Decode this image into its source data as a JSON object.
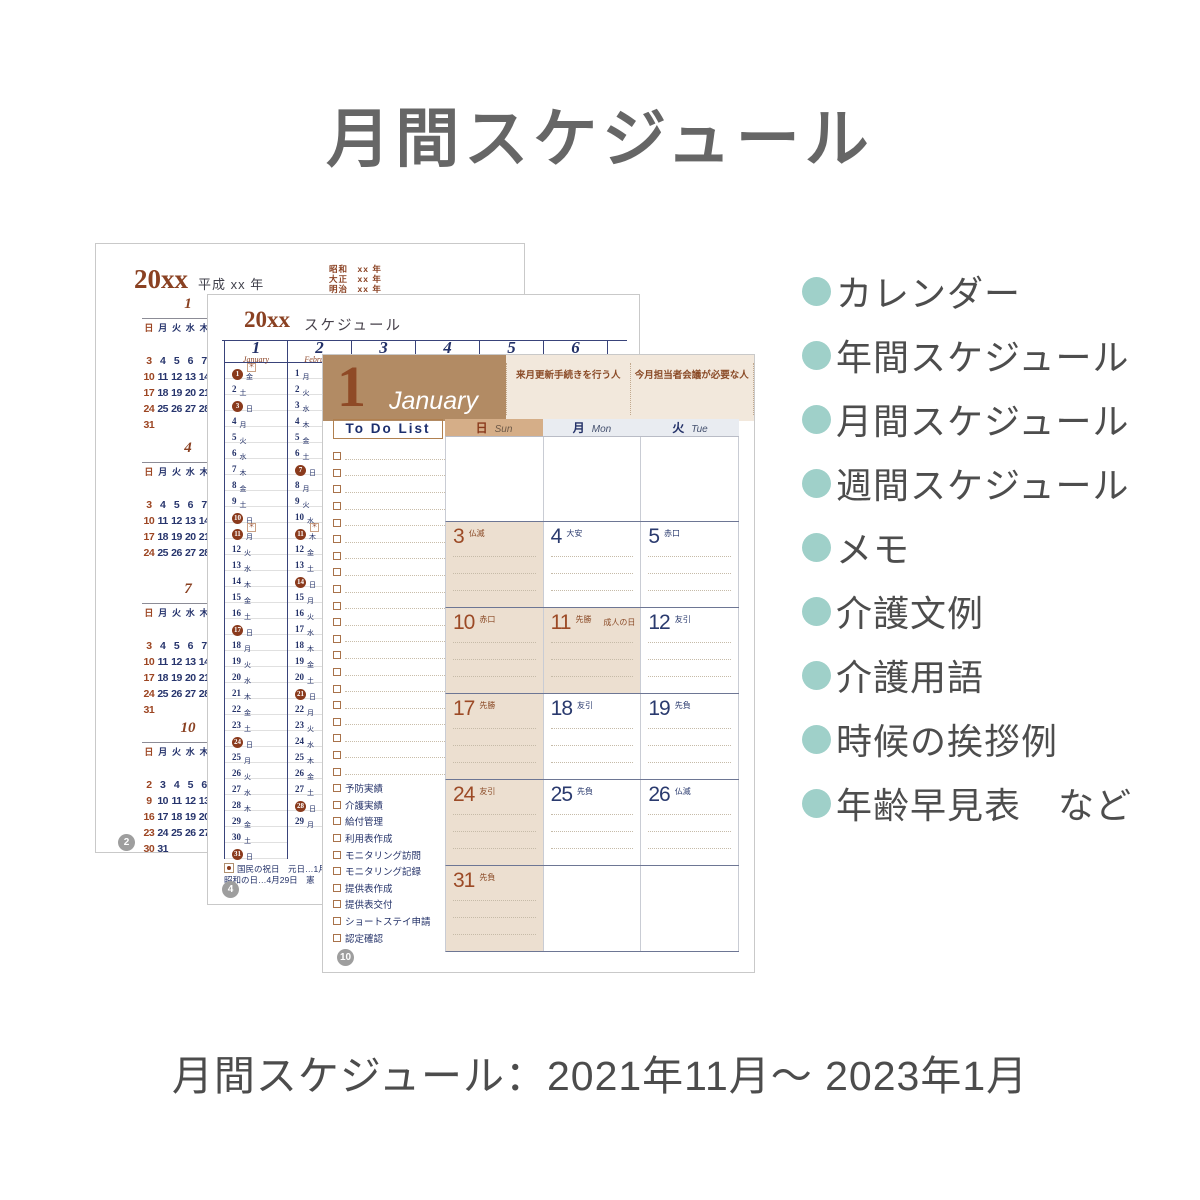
{
  "title": "月間スケジュール",
  "caption": "月間スケジュール：2021年11月～ 2023年1月",
  "features": {
    "bullet_color": "#9fd0c9",
    "items": [
      "カレンダー",
      "年間スケジュール",
      "月間スケジュール",
      "週間スケジュール",
      "メモ",
      "介護文例",
      "介護用語",
      "時候の挨拶例",
      "年齢早見表　など"
    ]
  },
  "colors": {
    "accent_teal": "#9fd0c9",
    "brown": "#8a4122",
    "navy": "#233168",
    "band_brown": "#b28b64",
    "band_beige": "#f2e8dc",
    "sunday_header": "#d5ae88",
    "weekday_header": "#e9ecf1",
    "sunday_cell": "#ecdfd0",
    "badge_gray": "#9e9e9e"
  },
  "page_calendar": {
    "page_number": "2",
    "year_label": "20xx",
    "era_label": "平成 xx 年",
    "era_small": [
      "昭和　xx 年",
      "大正　xx 年",
      "明治　xx 年"
    ],
    "weekdays": [
      "日",
      "月",
      "火",
      "水",
      "木",
      "金",
      "土"
    ],
    "months": [
      {
        "num": "1",
        "weeks": [
          [
            "",
            "",
            "",
            "",
            "",
            "1",
            "2"
          ],
          [
            "3",
            "4",
            "5",
            "6",
            "7",
            "8",
            "9"
          ],
          [
            "10",
            "11",
            "12",
            "13",
            "14",
            "15",
            "16"
          ],
          [
            "17",
            "18",
            "19",
            "20",
            "21",
            "22",
            "23"
          ],
          [
            "24",
            "25",
            "26",
            "27",
            "28",
            "29",
            "30"
          ],
          [
            "31",
            "",
            "",
            "",
            "",
            "",
            ""
          ]
        ]
      },
      {
        "num": "4",
        "weeks": [
          [
            "",
            "",
            "",
            "",
            "",
            "1",
            "2"
          ],
          [
            "3",
            "4",
            "5",
            "6",
            "7",
            "8",
            "9"
          ],
          [
            "10",
            "11",
            "12",
            "13",
            "14",
            "15",
            "16"
          ],
          [
            "17",
            "18",
            "19",
            "20",
            "21",
            "22",
            "23"
          ],
          [
            "24",
            "25",
            "26",
            "27",
            "28",
            "29",
            "30"
          ]
        ]
      },
      {
        "num": "7",
        "weeks": [
          [
            "",
            "",
            "",
            "",
            "",
            "1",
            "2"
          ],
          [
            "3",
            "4",
            "5",
            "6",
            "7",
            "8",
            "9"
          ],
          [
            "10",
            "11",
            "12",
            "13",
            "14",
            "15",
            "16"
          ],
          [
            "17",
            "18",
            "19",
            "20",
            "21",
            "22",
            "23"
          ],
          [
            "24",
            "25",
            "26",
            "27",
            "28",
            "29",
            "30"
          ],
          [
            "31",
            "",
            "",
            "",
            "",
            "",
            ""
          ]
        ]
      },
      {
        "num": "10",
        "weeks": [
          [
            "",
            "",
            "",
            "",
            "",
            "",
            "1"
          ],
          [
            "2",
            "3",
            "4",
            "5",
            "6",
            "7",
            "8"
          ],
          [
            "9",
            "10",
            "11",
            "12",
            "13",
            "14",
            "15"
          ],
          [
            "16",
            "17",
            "18",
            "19",
            "20",
            "21",
            "22"
          ],
          [
            "23",
            "24",
            "25",
            "26",
            "27",
            "28",
            "29"
          ],
          [
            "30",
            "31",
            "",
            "",
            "",
            "",
            ""
          ]
        ]
      }
    ]
  },
  "page_yearly": {
    "page_number": "4",
    "year_label": "20xx",
    "title": "スケジュール",
    "footnote1": "国民の祝日　元日…1月",
    "footnote2": "昭和の日…4月29日　憲",
    "columns": [
      {
        "num": "1",
        "name": "January",
        "days": [
          {
            "d": "1",
            "w": "金",
            "c": true,
            "m": true
          },
          {
            "d": "2",
            "w": "土"
          },
          {
            "d": "3",
            "w": "日",
            "c": true
          },
          {
            "d": "4",
            "w": "月"
          },
          {
            "d": "5",
            "w": "火"
          },
          {
            "d": "6",
            "w": "水"
          },
          {
            "d": "7",
            "w": "木"
          },
          {
            "d": "8",
            "w": "金"
          },
          {
            "d": "9",
            "w": "土"
          },
          {
            "d": "10",
            "w": "日",
            "c": true
          },
          {
            "d": "11",
            "w": "月",
            "c": true,
            "m": true
          },
          {
            "d": "12",
            "w": "火"
          },
          {
            "d": "13",
            "w": "水"
          },
          {
            "d": "14",
            "w": "木"
          },
          {
            "d": "15",
            "w": "金"
          },
          {
            "d": "16",
            "w": "土"
          },
          {
            "d": "17",
            "w": "日",
            "c": true
          },
          {
            "d": "18",
            "w": "月"
          },
          {
            "d": "19",
            "w": "火"
          },
          {
            "d": "20",
            "w": "水"
          },
          {
            "d": "21",
            "w": "木"
          },
          {
            "d": "22",
            "w": "金"
          },
          {
            "d": "23",
            "w": "土"
          },
          {
            "d": "24",
            "w": "日",
            "c": true
          },
          {
            "d": "25",
            "w": "月"
          },
          {
            "d": "26",
            "w": "火"
          },
          {
            "d": "27",
            "w": "水"
          },
          {
            "d": "28",
            "w": "木"
          },
          {
            "d": "29",
            "w": "金"
          },
          {
            "d": "30",
            "w": "土"
          },
          {
            "d": "31",
            "w": "日",
            "c": true
          }
        ]
      },
      {
        "num": "2",
        "name": "February",
        "days": [
          {
            "d": "1",
            "w": "月"
          },
          {
            "d": "2",
            "w": "火"
          },
          {
            "d": "3",
            "w": "水"
          },
          {
            "d": "4",
            "w": "木"
          },
          {
            "d": "5",
            "w": "金"
          },
          {
            "d": "6",
            "w": "土"
          },
          {
            "d": "7",
            "w": "日",
            "c": true
          },
          {
            "d": "8",
            "w": "月"
          },
          {
            "d": "9",
            "w": "火"
          },
          {
            "d": "10",
            "w": "水"
          },
          {
            "d": "11",
            "w": "木",
            "c": true,
            "m": true
          },
          {
            "d": "12",
            "w": "金"
          },
          {
            "d": "13",
            "w": "土"
          },
          {
            "d": "14",
            "w": "日",
            "c": true
          },
          {
            "d": "15",
            "w": "月"
          },
          {
            "d": "16",
            "w": "火"
          },
          {
            "d": "17",
            "w": "水"
          },
          {
            "d": "18",
            "w": "木"
          },
          {
            "d": "19",
            "w": "金"
          },
          {
            "d": "20",
            "w": "土"
          },
          {
            "d": "21",
            "w": "日",
            "c": true
          },
          {
            "d": "22",
            "w": "月"
          },
          {
            "d": "23",
            "w": "火"
          },
          {
            "d": "24",
            "w": "水"
          },
          {
            "d": "25",
            "w": "木"
          },
          {
            "d": "26",
            "w": "金"
          },
          {
            "d": "27",
            "w": "土"
          },
          {
            "d": "28",
            "w": "日",
            "c": true
          },
          {
            "d": "29",
            "w": "月"
          }
        ]
      },
      {
        "num": "3",
        "name": "March",
        "days": []
      },
      {
        "num": "4",
        "name": "April",
        "days": []
      },
      {
        "num": "5",
        "name": "May",
        "days": []
      },
      {
        "num": "6",
        "name": "June",
        "days": []
      }
    ]
  },
  "page_monthly": {
    "page_number": "10",
    "month_num": "1",
    "month_name": "January",
    "note_labels": [
      "来月更新手続きを行う人",
      "今月担当者会議が必要な人"
    ],
    "todo_title": "To Do List",
    "todo_empty_rows": 20,
    "todo_items": [
      "予防実績",
      "介護実績",
      "給付管理",
      "利用表作成",
      "モニタリング訪問",
      "モニタリング記録",
      "提供表作成",
      "提供表交付",
      "ショートステイ申請",
      "認定確認"
    ],
    "day_headers": [
      {
        "jp": "日",
        "en": "Sun"
      },
      {
        "jp": "月",
        "en": "Mon"
      },
      {
        "jp": "火",
        "en": "Tue"
      }
    ],
    "weeks": [
      [
        {},
        {},
        {}
      ],
      [
        {
          "d": "3",
          "r": "仏滅",
          "tan": true
        },
        {
          "d": "4",
          "r": "大安"
        },
        {
          "d": "5",
          "r": "赤口"
        }
      ],
      [
        {
          "d": "10",
          "r": "赤口",
          "tan": true
        },
        {
          "d": "11",
          "r": "先勝",
          "note": "成人の日",
          "tan": true
        },
        {
          "d": "12",
          "r": "友引"
        }
      ],
      [
        {
          "d": "17",
          "r": "先勝",
          "tan": true
        },
        {
          "d": "18",
          "r": "友引"
        },
        {
          "d": "19",
          "r": "先負"
        }
      ],
      [
        {
          "d": "24",
          "r": "友引",
          "tan": true
        },
        {
          "d": "25",
          "r": "先負"
        },
        {
          "d": "26",
          "r": "仏滅"
        }
      ],
      [
        {
          "d": "31",
          "r": "先負",
          "tan": true
        },
        {},
        {}
      ]
    ]
  }
}
